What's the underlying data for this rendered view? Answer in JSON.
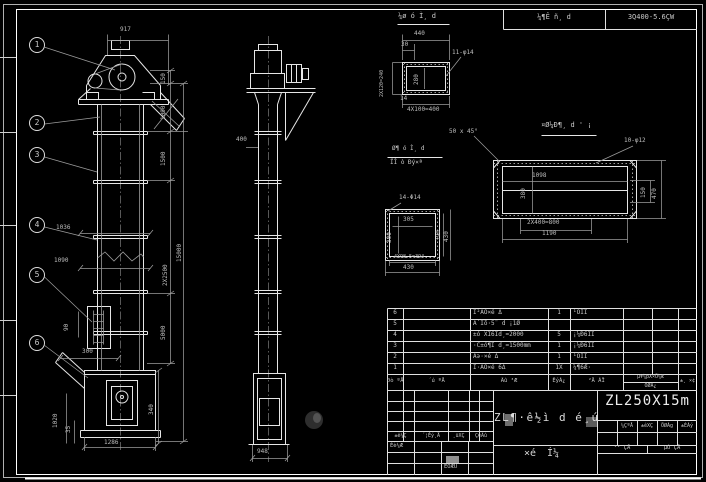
{
  "top_header": {
    "left_label": "¼¶Ê ñ¸ d",
    "right_label": "3Q400-5.6ÇW"
  },
  "front_view": {
    "balloons": [
      "1",
      "2",
      "3",
      "4",
      "5",
      "6"
    ],
    "dims": {
      "top_width": "917",
      "h1": "150",
      "h2": "1090",
      "h3": "1500",
      "total_height": "15000",
      "mid_sections": "2X2500",
      "lower": "5000",
      "boot_right": "340",
      "left_a": "1036",
      "left_b": "1090",
      "left_c": "90",
      "left_d": "300",
      "boot_left": "1020",
      "boot_small": "35",
      "base_width": "1286"
    }
  },
  "side_view": {
    "dims": {
      "head": "400",
      "base_width": "948"
    }
  },
  "detail_top_flange": {
    "title": "¼ø ó Ì¸ d",
    "dims": {
      "width": "440",
      "offset": "30",
      "holes": "11-φ14",
      "inner": "280",
      "left": "2X120=240",
      "corner": "14",
      "bottom": "4X100=400"
    }
  },
  "detail_inlet": {
    "title": "¤Ø¼Ð¶¸ d ' ¡",
    "chamfer": "50 x 45°",
    "holes": "10-φ12",
    "dims": {
      "inner_width": "1098",
      "inner_height": "380",
      "right_a": "150",
      "right_b": "470",
      "bottom_a": "2X400=800",
      "bottom_b": "1190"
    }
  },
  "detail_square_flange": {
    "title_line1": "Ø¶ ó Ì¸ d",
    "title_line2": "ÏÎ ò Ðý×ª",
    "holes": "14-Φ14",
    "dims": {
      "inner_width": "305",
      "inner_height": "300",
      "right_a": "390",
      "right_b": "430",
      "bottom_a": "4X98.5=394",
      "bottom_b": "430"
    }
  },
  "bom": {
    "headers": {
      "seq": "Ðò ºÅ",
      "code": "´ú ºÅ",
      "name": "Ãû ³Æ",
      "qty": "ÊýÁ¿",
      "material": "²Ä ÁÏ",
      "weight_top": "µ¥¼þX×Ü¼Æ",
      "weight_bottom": "ÖØÁ¿",
      "remark": "±¸ ×¢"
    },
    "rows": [
      {
        "no": "6",
        "name": "Î²ÂÖ×é Δ",
        "qty": "1",
        "material": "¹ÓÍÎ"
      },
      {
        "no": "5",
        "name": "Á´Ìõ·5¨ d ¡1Ø",
        "qty": "",
        "material": ""
      },
      {
        "no": "4",
        "name": "±ó XÌ6Îd¸=2000",
        "qty": "5",
        "material": "¡¼Ð6ÌÎ"
      },
      {
        "no": "3",
        "name": "·C±ó¶Ì d¸=1500mm",
        "qty": "1",
        "material": "¡¼Ð6ÌÎ"
      },
      {
        "no": "2",
        "name": "Á϶·×é Δ",
        "qty": "1",
        "material": "¹ÓÍÎ"
      },
      {
        "no": "1",
        "name": "Í·ÂÖ×é 6Δ",
        "qty": "1X",
        "material": "¼¶6Æ·"
      }
    ]
  },
  "title_block": {
    "drawing_title": "ZL¶·ê½ì d é¸ú",
    "model": "ZL250X15m",
    "sheet_type_left": "×é",
    "sheet_type_right": "Í¼",
    "rev_headers": [
      "±ê¼Ç",
      "´¦Êý¸Ä",
      "¸üXÇ",
      "Ç©Ãû"
    ],
    "designer_label": "Éè¼Æ",
    "date_label": "ÈÕÆÚ",
    "info_cells": [
      "¼ÇºÅ",
      "±êXÇ",
      "ÖØÁg",
      "±ÈÀý"
    ],
    "sheet_total": "¹² ÇÅ",
    "sheet_no": "µÚ ÇÅ"
  }
}
